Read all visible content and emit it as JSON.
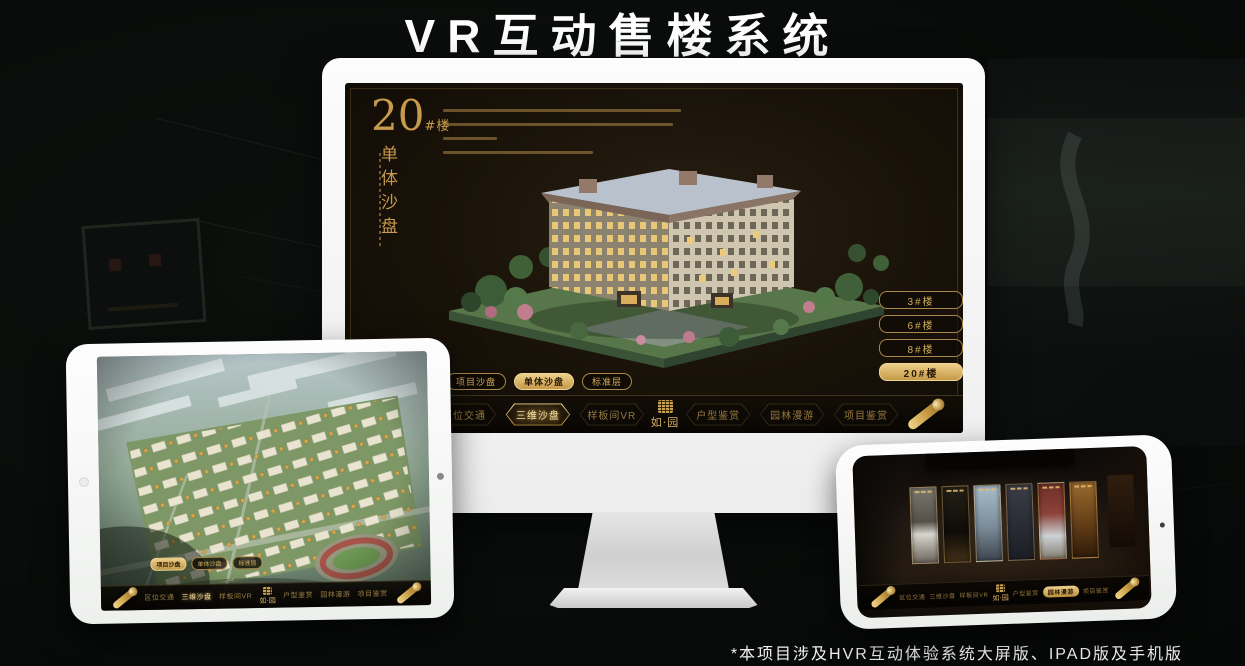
{
  "header": {
    "title": "VR互动售楼系统"
  },
  "footer": {
    "note": "*本项目涉及HVR互动体验系统大屏版、IPAD版及手机版"
  },
  "brand": {
    "name": "如·园"
  },
  "colors": {
    "gold": "#c9a256",
    "gold_bright": "#eecf8b",
    "screen_bg": "#1a1309",
    "background": "#090c0a",
    "device_white": "#f5f6f5"
  },
  "monitor": {
    "title_block": {
      "number": "20",
      "unit": "#楼",
      "subtitle": "单体沙盘"
    },
    "floor_buttons": [
      {
        "label": "3#楼",
        "active": false
      },
      {
        "label": "6#楼",
        "active": false
      },
      {
        "label": "8#楼",
        "active": false
      },
      {
        "label": "20#楼",
        "active": true
      }
    ],
    "view_tabs": [
      {
        "label": "项目沙盘",
        "active": false
      },
      {
        "label": "单体沙盘",
        "active": true
      },
      {
        "label": "标准层",
        "active": false
      }
    ],
    "nav_items": [
      {
        "label": "区位交通",
        "active": false
      },
      {
        "label": "三维沙盘",
        "active": true
      },
      {
        "label": "样板间VR",
        "active": false
      },
      {
        "label": "户型鉴赏",
        "active": false
      },
      {
        "label": "园林漫游",
        "active": false
      },
      {
        "label": "项目鉴赏",
        "active": false
      }
    ]
  },
  "tablet": {
    "view_tabs": [
      {
        "label": "项目沙盘",
        "active": true
      },
      {
        "label": "单体沙盘",
        "active": false
      },
      {
        "label": "标准层",
        "active": false
      }
    ],
    "nav_items": [
      {
        "label": "区位交通",
        "active": false
      },
      {
        "label": "三维沙盘",
        "active": true
      },
      {
        "label": "样板间VR",
        "active": false
      },
      {
        "label": "户型鉴赏",
        "active": false
      },
      {
        "label": "园林漫游",
        "active": false
      },
      {
        "label": "项目鉴赏",
        "active": false
      }
    ]
  },
  "phone": {
    "nav_items": [
      {
        "label": "区位交通",
        "active": false
      },
      {
        "label": "三维沙盘",
        "active": false
      },
      {
        "label": "样板间VR",
        "active": false
      },
      {
        "label": "户型鉴赏",
        "active": false
      },
      {
        "label": "园林漫游",
        "active": true
      },
      {
        "label": "项目鉴赏",
        "active": false
      }
    ]
  }
}
